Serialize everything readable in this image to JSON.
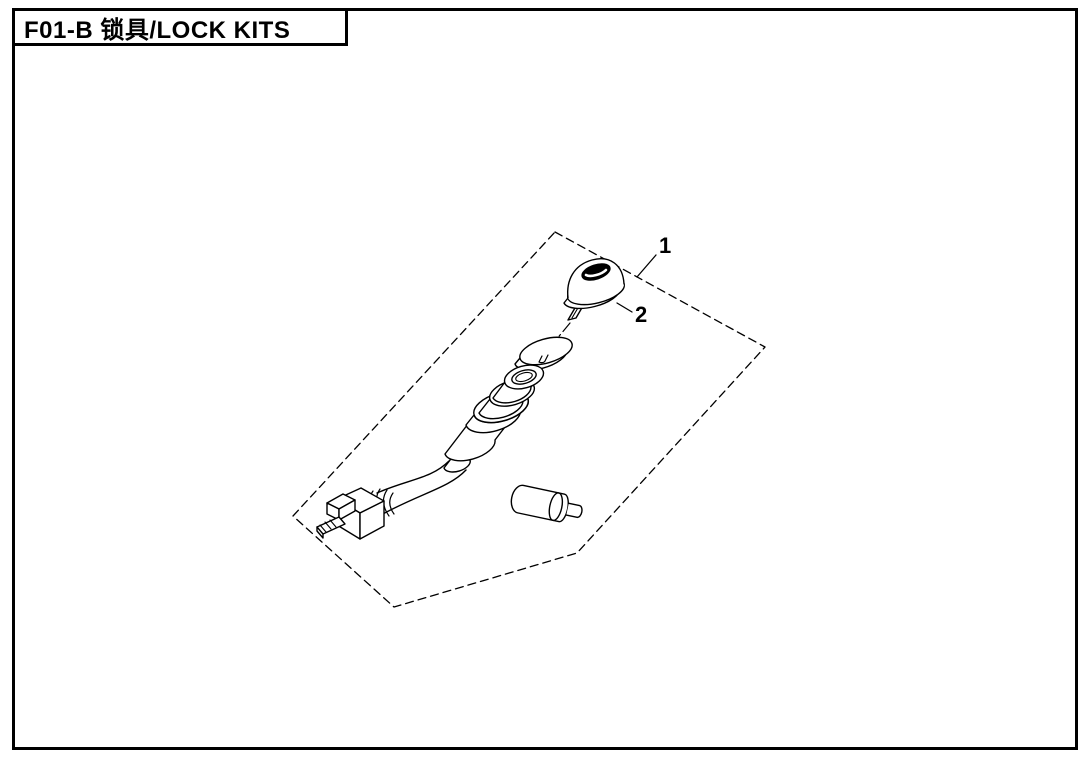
{
  "page": {
    "title": "F01-B 锁具/LOCK KITS"
  },
  "diagram": {
    "callouts": [
      {
        "label": "1",
        "refers_to": "lock-kit-assembly-boundary"
      },
      {
        "label": "2",
        "refers_to": "key"
      }
    ],
    "parts": [
      "key",
      "washer-collar",
      "ignition-switch-body",
      "wire-harness",
      "wire-connector-plug",
      "key-blank-cylinder"
    ],
    "boundary_style": "dashed",
    "colors": {
      "line": "#000000",
      "background": "#ffffff"
    }
  }
}
